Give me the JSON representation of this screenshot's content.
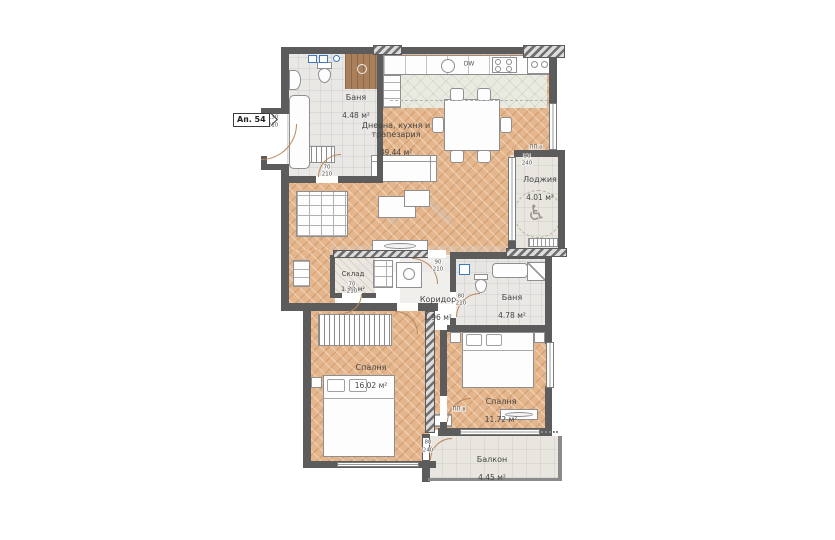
{
  "apartment": {
    "label": "Ап. 54"
  },
  "rooms": {
    "bath1": {
      "name": "Баня",
      "area": "4.48 м²"
    },
    "living": {
      "name": "Дневна, кухня и\nтрапезария",
      "area": "39.44 м²"
    },
    "loggia": {
      "name": "Лоджия",
      "area": "4.01 м²"
    },
    "storage": {
      "name": "Склад",
      "area": "1.32 м²"
    },
    "corridor": {
      "name": "Коридор",
      "area": "1.96 м²"
    },
    "bath2": {
      "name": "Баня",
      "area": "4.78 м²"
    },
    "bedroom1": {
      "name": "Спалня",
      "area": "16.02 м²"
    },
    "bedroom2": {
      "name": "Спалня",
      "area": "11.72 м²"
    },
    "balcony": {
      "name": "Балкон",
      "area": "4.45 м²"
    }
  },
  "kitchen": {
    "dishwasher_label": "DW"
  },
  "icons": {
    "wheelchair": "♿"
  },
  "colors": {
    "wall": "#5c5c5c",
    "wood_floor": "#e5b68c",
    "accent_blue": "#3a7bbf"
  },
  "dim_labels": [
    {
      "text": "130",
      "x": 273,
      "y": 117
    },
    {
      "text": "210",
      "x": 273,
      "y": 125
    },
    {
      "text": "70",
      "x": 327,
      "y": 167
    },
    {
      "text": "210",
      "x": 327,
      "y": 174
    },
    {
      "text": "90",
      "x": 438,
      "y": 262
    },
    {
      "text": "210",
      "x": 438,
      "y": 269
    },
    {
      "text": "70",
      "x": 352,
      "y": 284
    },
    {
      "text": "210",
      "x": 352,
      "y": 291
    },
    {
      "text": "80",
      "x": 461,
      "y": 296
    },
    {
      "text": "210",
      "x": 461,
      "y": 303
    },
    {
      "text": "ПП.о",
      "x": 536,
      "y": 147
    },
    {
      "text": "90",
      "x": 527,
      "y": 156
    },
    {
      "text": "240",
      "x": 527,
      "y": 163
    },
    {
      "text": "ПП.в",
      "x": 459,
      "y": 409
    },
    {
      "text": "80",
      "x": 428,
      "y": 442
    },
    {
      "text": "240",
      "x": 428,
      "y": 450
    }
  ]
}
